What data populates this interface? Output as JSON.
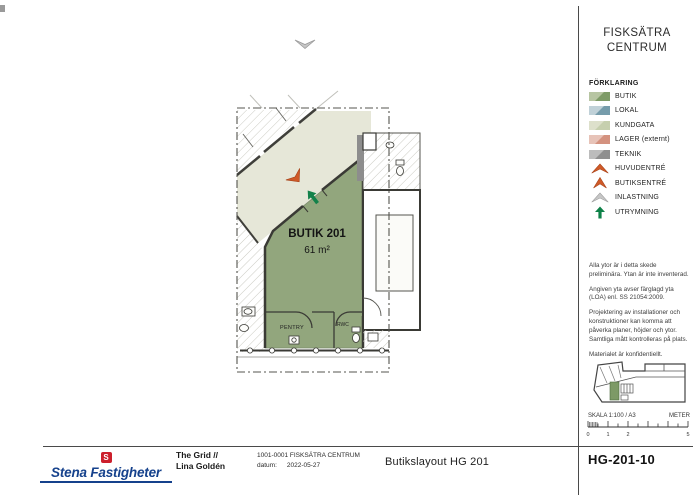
{
  "sidebar": {
    "title_line1": "FISKSÄTRA",
    "title_line2": "CENTRUM",
    "legend": {
      "heading": "FÖRKLARING",
      "items": [
        {
          "label": "BUTIK",
          "icon": "swatch-butik",
          "color_light": "#b7c5a2",
          "color_dark": "#7e9b67"
        },
        {
          "label": "LOKAL",
          "icon": "swatch-lokal",
          "color_light": "#c0d1d8",
          "color_dark": "#769cab"
        },
        {
          "label": "KUNDGATA",
          "icon": "swatch-kundgata",
          "color_light": "#dde0cb",
          "color_dark": "#c6cfae"
        },
        {
          "label": "LAGER (externt)",
          "icon": "swatch-lager",
          "color_light": "#e7c3b8",
          "color_dark": "#d4927f"
        },
        {
          "label": "TEKNIK",
          "icon": "swatch-teknik",
          "color_light": "#bcbcbc",
          "color_dark": "#8f8f8f"
        },
        {
          "label": "HUVUDENTRÉ",
          "icon": "chevron-orange",
          "color": "#c85426"
        },
        {
          "label": "BUTIKSENTRÉ",
          "icon": "arrowhead-orange",
          "color": "#c85426"
        },
        {
          "label": "INLASTNING",
          "icon": "chevron-gray",
          "color": "#c2c2c2"
        },
        {
          "label": "UTRYMNING",
          "icon": "arrow-green",
          "color": "#0e8148"
        }
      ]
    },
    "notes": [
      "Alla ytor är i detta skede preliminära. Ytan är inte inventerad.",
      "Angiven yta avser färglagd yta (LOA) enl. SS 21054:2009.",
      "Projektering av installationer och konstruktioner kan komma att påverka planer, höjder och ytor. Samtliga mått kontrolleras på plats.",
      "Materialet är konfidentiellt."
    ],
    "scale": {
      "label": "SKALA 1:100 / A3",
      "unit": "METER",
      "ticks": [
        "0",
        "1",
        "2",
        "5"
      ]
    },
    "drawing_number": "HG-201-10"
  },
  "plan": {
    "room_label": "BUTIK 201",
    "room_area": "61 m²",
    "pentry_label": "PENTRY",
    "rwc_label": "RWC",
    "colors": {
      "butik_fill": "#92a67d",
      "kundgata_fill": "#e6e7d8",
      "entry_arrow": "#cf5a28",
      "escape_arrow": "#13814a",
      "loading_arrow": "#c2c2c2"
    }
  },
  "titleblock": {
    "logo_s": "S",
    "logo_text": "Stena Fastigheter",
    "company": "The Grid //",
    "author": "Lina Goldén",
    "project": "1001-0001 FISKSÄTRA CENTRUM",
    "date_label": "datum:",
    "date": "2022-05-27",
    "drawing_title": "Butikslayout HG 201"
  }
}
